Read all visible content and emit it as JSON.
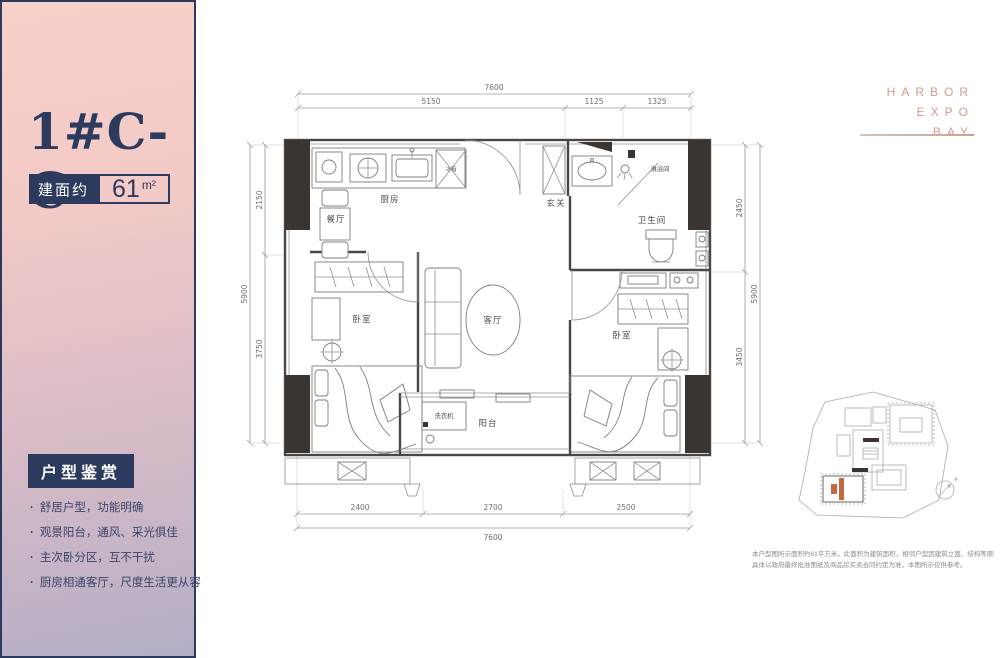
{
  "brand": {
    "words": [
      "HARBOR",
      "EXPO",
      "BAY"
    ]
  },
  "panel": {
    "title": "1#C-C",
    "area_label": "建面约",
    "area_value": "61",
    "area_unit": "m²",
    "section_title": "户型鉴赏",
    "features": [
      "舒居户型，功能明确",
      "观景阳台，通风、采光俱佳",
      "主次卧分区，互不干扰",
      "厨房相通客厅，尺度生活更从容"
    ]
  },
  "floorplan": {
    "rooms": {
      "kitchen": "厨房",
      "dining": "餐厅",
      "entry": "玄关",
      "shower": "淋浴间",
      "bath": "卫生间",
      "living": "客厅",
      "bedroom_left": "卧室",
      "bedroom_right": "卧室",
      "balcony": "阳台"
    },
    "fixtures": {
      "washer": "洗衣机",
      "fridge": "冰箱"
    },
    "dimensions": {
      "top_total": "7600",
      "top_segments": [
        "5150",
        "1125",
        "1325"
      ],
      "bottom_segments": [
        "2400",
        "2700",
        "2500"
      ],
      "bottom_total": "7600",
      "right_segments": [
        "2450",
        "3450"
      ],
      "right_total": "5900",
      "left_segments": [
        "2150",
        "3750"
      ],
      "left_total": "5900"
    }
  },
  "disclaimer": {
    "line1": "本户型图所示面积约61平方米，此面积为建筑面积，相邻户型因建筑立面、结构等原因局部有别，",
    "line2": "具体以政府最终批准图纸及商品房买卖合同约定为准，本图所示仅供参考。"
  },
  "colors": {
    "navy": "#2c3a5e",
    "rose": "#cf9e92",
    "highlight": "#c4693f"
  }
}
